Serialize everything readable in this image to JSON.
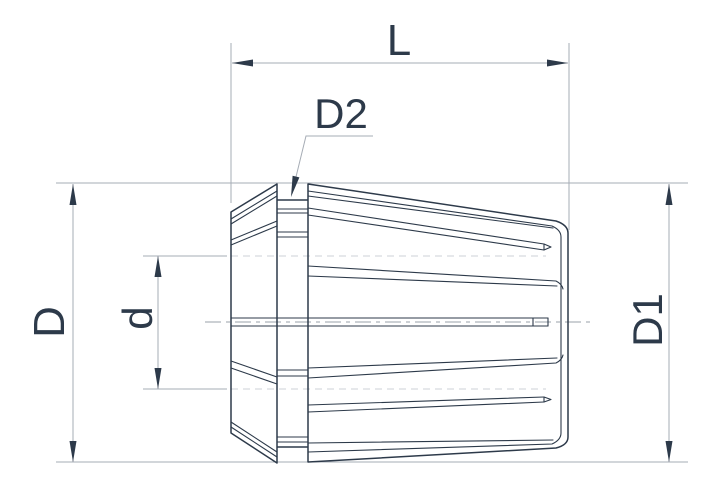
{
  "drawing": {
    "kind": "technical-dimension-drawing",
    "dimensions": {
      "overall_length": {
        "label": "L"
      },
      "groove_diameter": {
        "label": "D2"
      },
      "big_end_diameter": {
        "label": "D"
      },
      "bore_diameter": {
        "label": "d"
      },
      "body_diameter": {
        "label": "D1"
      }
    },
    "colors": {
      "background": "#ffffff",
      "object_line": "#2d3a4a",
      "label_text": "#2d3a4a",
      "dimension_line": "#a6acb5",
      "centerline": "#9aa1aa",
      "faint_reference_line": "#ccd1d7"
    }
  }
}
